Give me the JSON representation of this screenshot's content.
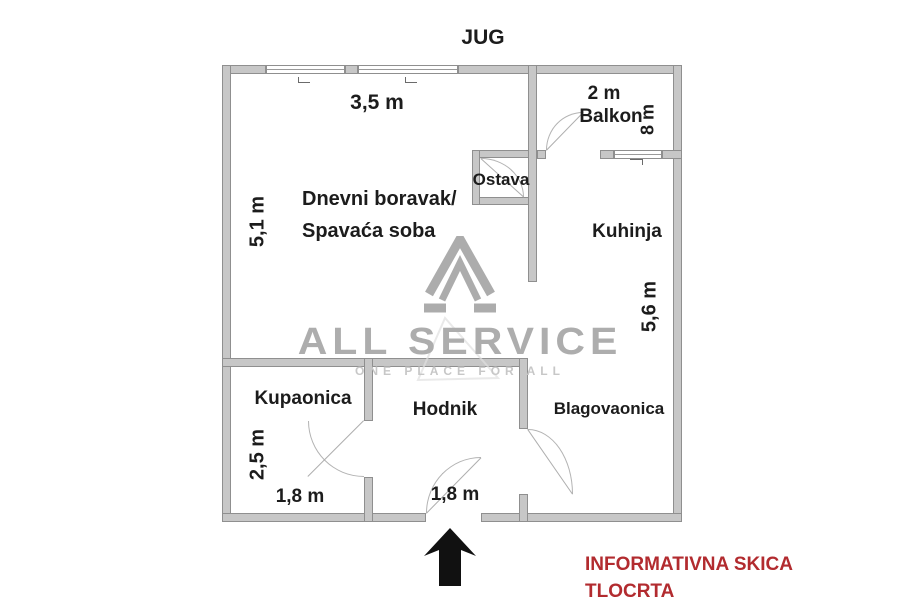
{
  "compass": {
    "label": "JUG"
  },
  "plan": {
    "rooms": {
      "living": {
        "line1": "Dnevni boravak/",
        "line2": "Spavaća soba",
        "top_dim": "3,5 m",
        "left_dim": "5,1 m"
      },
      "balcony": {
        "name": "Balkon",
        "width_dim": "2 m",
        "side_dim": "8 m"
      },
      "storage": {
        "name": "Ostava"
      },
      "kitchen": {
        "name": "Kuhinja",
        "side_dim": "5,6 m"
      },
      "bathroom": {
        "name": "Kupaonica",
        "left_dim": "2,5 m",
        "bottom_dim": "1,8 m"
      },
      "hallway": {
        "name": "Hodnik",
        "bottom_dim": "1,8 m"
      },
      "dining": {
        "name": "Blagovaonica"
      }
    }
  },
  "watermark": {
    "brand": "ALL SERVICE",
    "tagline": "ONE PLACE FOR ALL"
  },
  "footer": {
    "line1": "INFORMATIVNA SKICA",
    "line2": "TLOCRTA"
  },
  "colors": {
    "wall_fill": "#c7c7c7",
    "wall_border": "#8f8f8f",
    "label_text": "#1c1c1c",
    "watermark_gray": "#adadad",
    "disclaimer_red": "#b22b2f",
    "arrow_black": "#111111"
  }
}
